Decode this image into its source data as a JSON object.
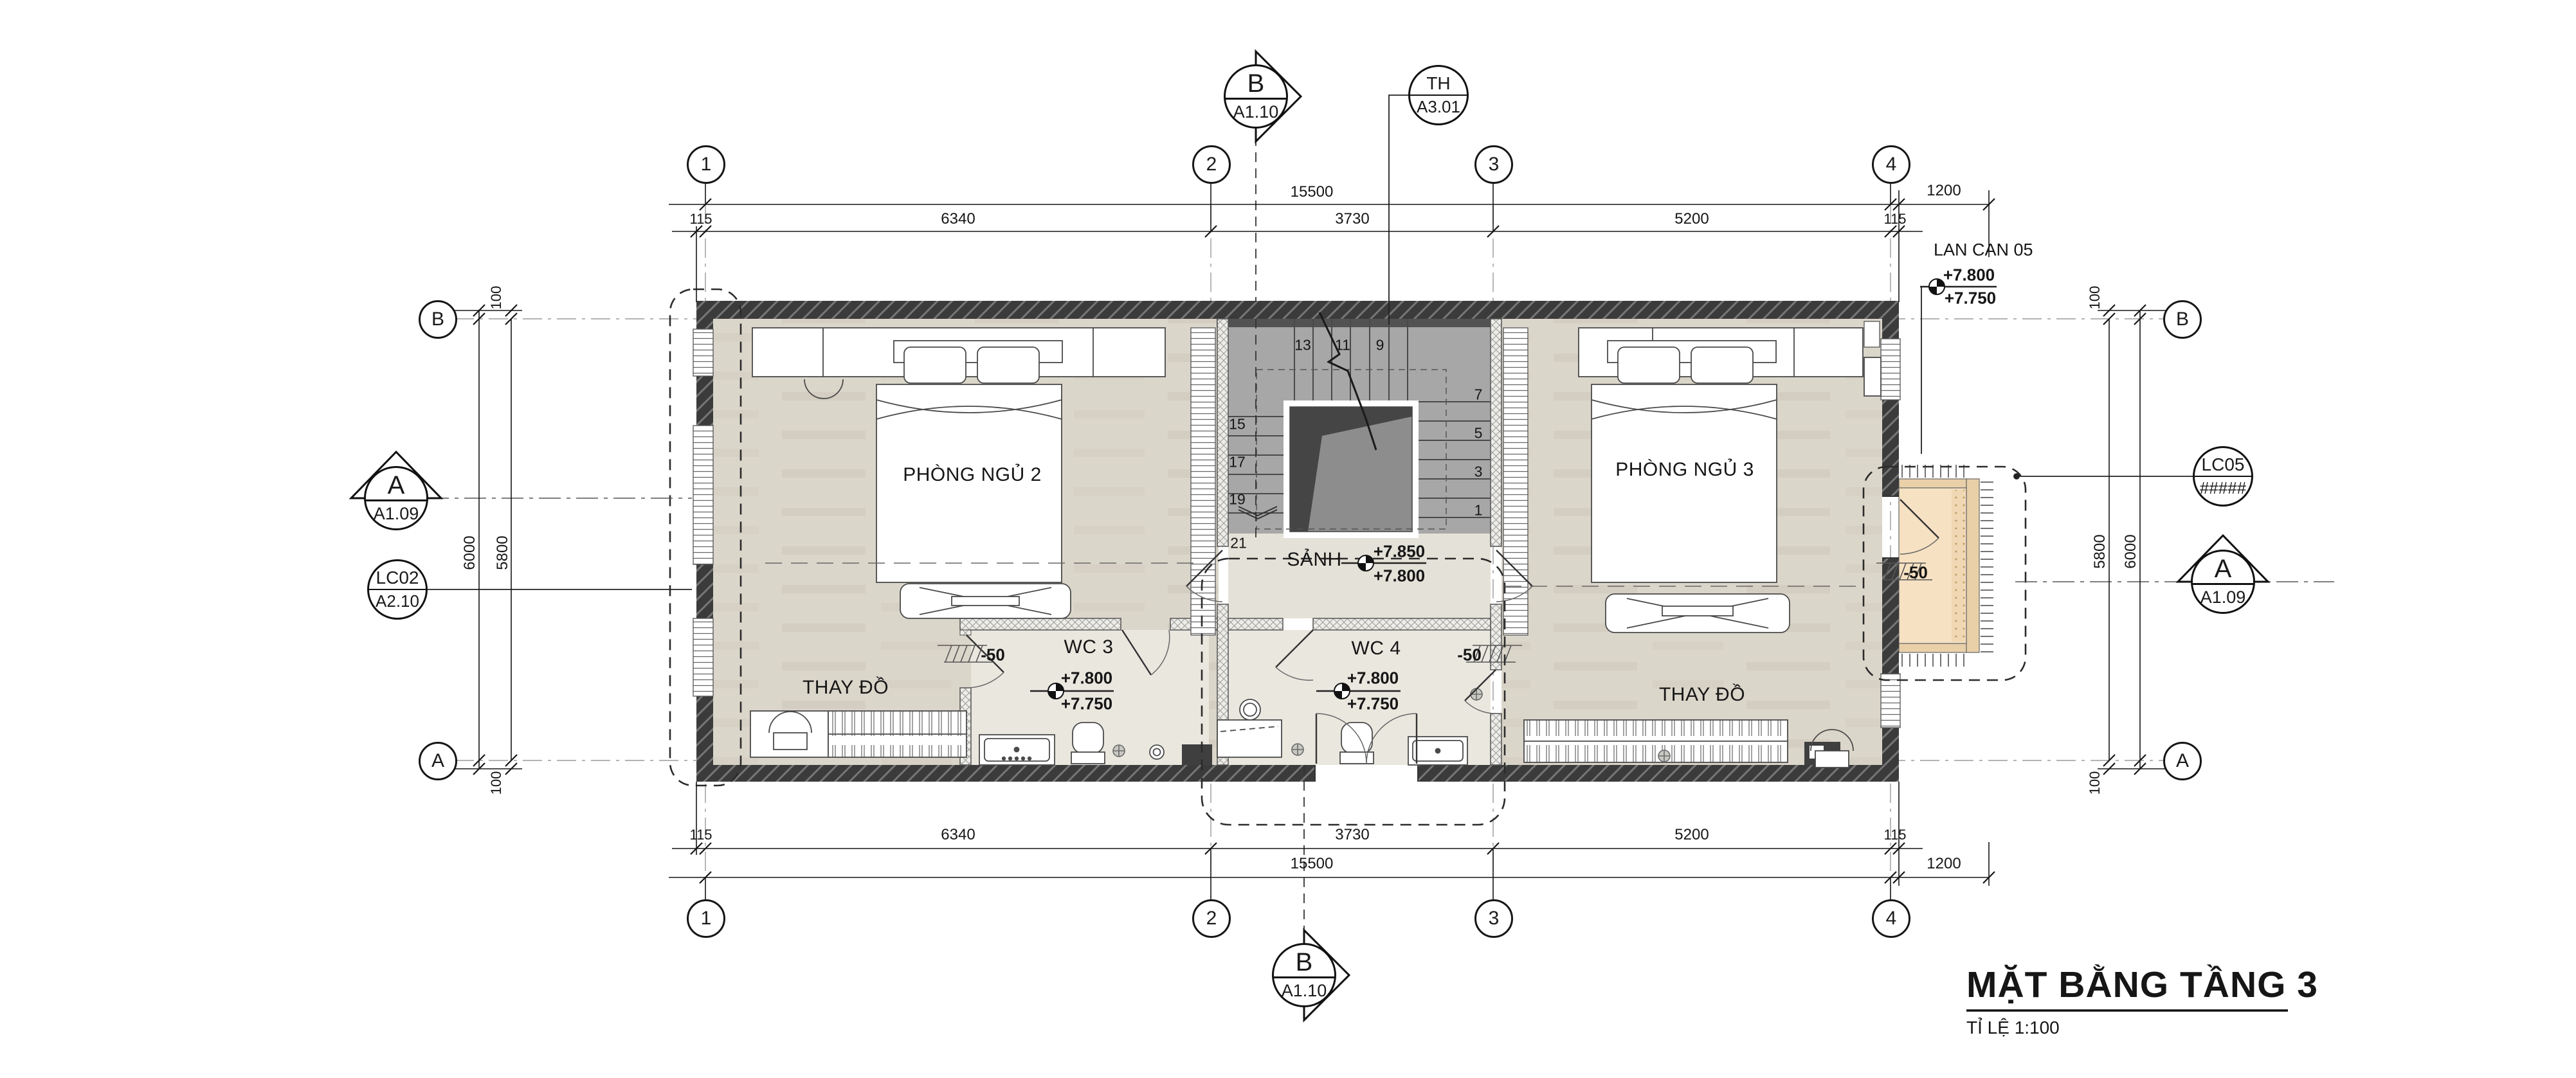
{
  "drawing": {
    "title": "MẶT BẰNG TẦNG 3",
    "scale_label": "TỈ LỆ 1:100"
  },
  "grid": {
    "cols": [
      "1",
      "2",
      "3",
      "4"
    ],
    "rows": [
      "B",
      "A"
    ]
  },
  "markers": {
    "section_b": {
      "label": "B",
      "sheet": "A1.10"
    },
    "section_a": {
      "label": "A",
      "sheet": "A1.09"
    },
    "stair_callout": {
      "label": "TH",
      "sheet": "A3.01"
    },
    "lc02": {
      "label": "LC02",
      "sheet": "A2.10"
    },
    "lc05": {
      "label": "LC05",
      "sheet": "#####"
    }
  },
  "railing_note": {
    "label": "LAN CAN 05",
    "upper": "+7.800",
    "lower": "+7.750"
  },
  "rooms": {
    "bedroom2": {
      "name": "PHÒNG NGỦ 2"
    },
    "bedroom3": {
      "name": "PHÒNG NGỦ 3"
    },
    "hall": {
      "name": "SẢNH",
      "upper": "+7.850",
      "lower": "+7.800"
    },
    "wc3": {
      "name": "WC 3",
      "upper": "+7.800",
      "lower": "+7.750"
    },
    "wc4": {
      "name": "WC 4",
      "upper": "+7.800",
      "lower": "+7.750"
    },
    "dressing": {
      "name": "THAY ĐỒ"
    }
  },
  "levels": {
    "threshold": "-50"
  },
  "dims": {
    "seg": [
      "115",
      "6340",
      "3730",
      "5200",
      "115"
    ],
    "total": "15500",
    "offset": "1200",
    "v_inner": "5800",
    "v_outer": "6000",
    "v_edge": "100"
  },
  "stair": {
    "upper": [
      "13",
      "11",
      "9"
    ],
    "left": [
      "15",
      "17",
      "19",
      "21"
    ],
    "right": [
      "7",
      "5",
      "3",
      "1"
    ]
  },
  "colors": {
    "floor": "#dbd6ca",
    "wc_floor": "#eae7df",
    "hall_floor": "#e4e1d8",
    "balcony_floor": "#f6e1c2",
    "wall": "#3b3b3b",
    "stair_tread": "#a7a7a7",
    "stair_void": "#454545"
  }
}
